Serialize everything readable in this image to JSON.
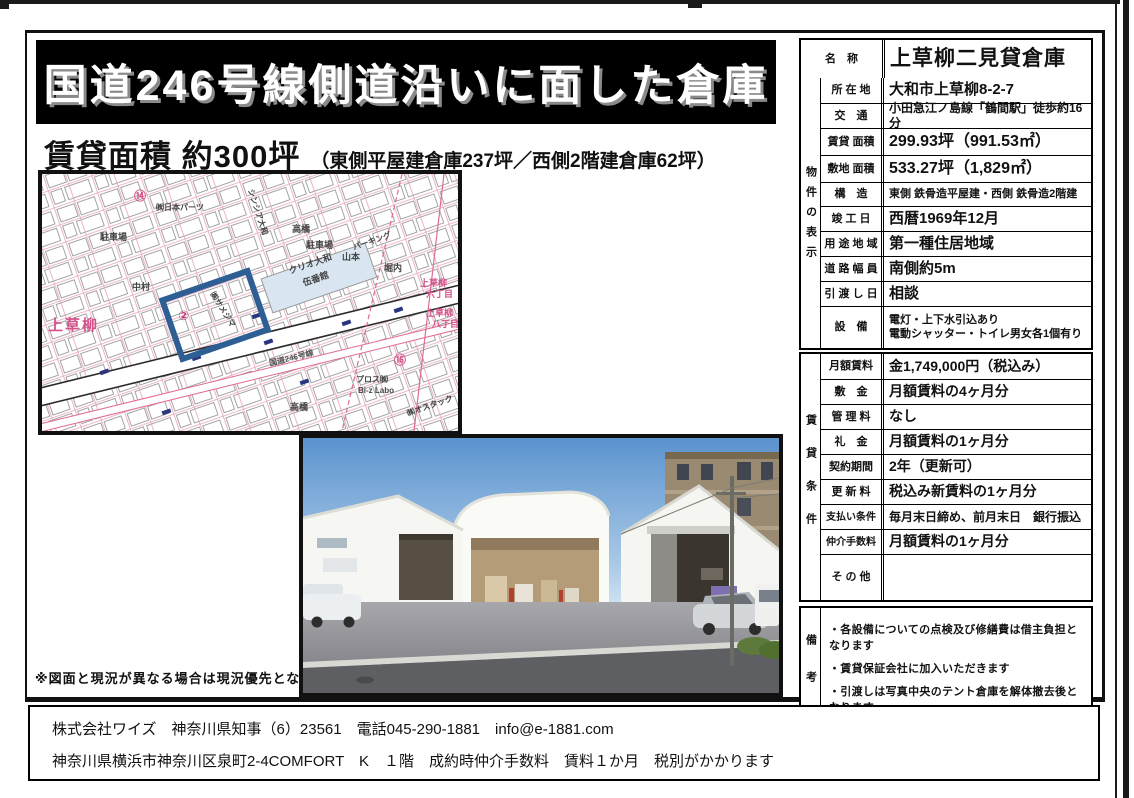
{
  "page": {
    "title": "国道246号線側道沿いに面した倉庫",
    "subtitle_main": "賃貸面積 約300坪",
    "subtitle_sub": "（東側平屋建倉庫237坪／西側2階建倉庫62坪）",
    "map_note": "※図面と現況が異なる場合は現況優先となります"
  },
  "property_table": {
    "section_label": "物件の表示",
    "name_row": {
      "label": "名　称",
      "value": "上草柳二見貸倉庫"
    },
    "rows": [
      {
        "label": "所 在 地",
        "value": "大和市上草柳8-2-7"
      },
      {
        "label": "交　通",
        "value": "小田急江ノ島線「鶴間駅」徒歩約16分"
      },
      {
        "label": "賃貸 面積",
        "value": "299.93坪（991.53㎡）"
      },
      {
        "label": "敷地 面積",
        "value": "533.27坪（1,829㎡）"
      },
      {
        "label": "構　造",
        "value": "東側 鉄骨造平屋建・西側 鉄骨造2階建"
      },
      {
        "label": "竣 工 日",
        "value": "西暦1969年12月"
      },
      {
        "label": "用 途 地 域",
        "value": "第一種住居地域"
      },
      {
        "label": "道 路 幅 員",
        "value": "南側約5m"
      },
      {
        "label": "引 渡 し 日",
        "value": "相談"
      },
      {
        "label": "設　備",
        "value": "電灯・上下水引込あり\n電動シャッター・トイレ男女各1個有り"
      }
    ]
  },
  "rental_table": {
    "section_label": "賃貸条件",
    "rows": [
      {
        "label": "月額賃料",
        "value": "金1,749,000円（税込み）"
      },
      {
        "label": "敷　金",
        "value": "月額賃料の4ヶ月分"
      },
      {
        "label": "管 理 料",
        "value": "なし"
      },
      {
        "label": "礼　金",
        "value": "月額賃料の1ヶ月分"
      },
      {
        "label": "契約期間",
        "value": "2年（更新可）"
      },
      {
        "label": "更 新 料",
        "value": "税込み新賃料の1ヶ月分"
      },
      {
        "label": "支払い条件",
        "value": "毎月末日締め、前月末日　銀行振込"
      },
      {
        "label": "仲介手数料",
        "value": "月額賃料の1ヶ月分"
      },
      {
        "label": "そ の 他",
        "value": ""
      }
    ]
  },
  "remarks": {
    "section_label": "備考",
    "items": [
      "・各設備についての点検及び修繕費は借主負担となります",
      "・賃貸保証会社に加入いただきます",
      "・引渡しは写真中央のテント倉庫を解体撤去後となります。"
    ]
  },
  "map": {
    "labels": {
      "area": "上草柳",
      "num14": "⑭",
      "num2": "②",
      "num16": "⑯",
      "nihonparts": "㈱日本パーツ",
      "shinshia": "シンシア大和",
      "takahashi": "高橋",
      "parking": "駐車場",
      "nakamura": "中村",
      "yamamoto": "山本",
      "parkingkata": "パーキング",
      "horiuchi": "堀内",
      "clio1": "クリオ大和",
      "clio2": "伍番館",
      "route": "国道246号線",
      "chome_a": "上草柳",
      "chome6": "六丁目",
      "chome8": "八丁目",
      "pros": "プロス㈱",
      "bizlabo": "Bi-z Labo",
      "ostack": "㈱オスタック",
      "highlight": "㈱サメジマ"
    }
  },
  "footer": {
    "line1": "株式会社ワイズ　神奈川県知事（6）23561　電話045-290-1881　info@e-1881.com",
    "line2": "神奈川県横浜市神奈川区泉町2-4COMFORT　K　１階　成約時仲介手数料　賃料１か月　税別がかかります"
  }
}
